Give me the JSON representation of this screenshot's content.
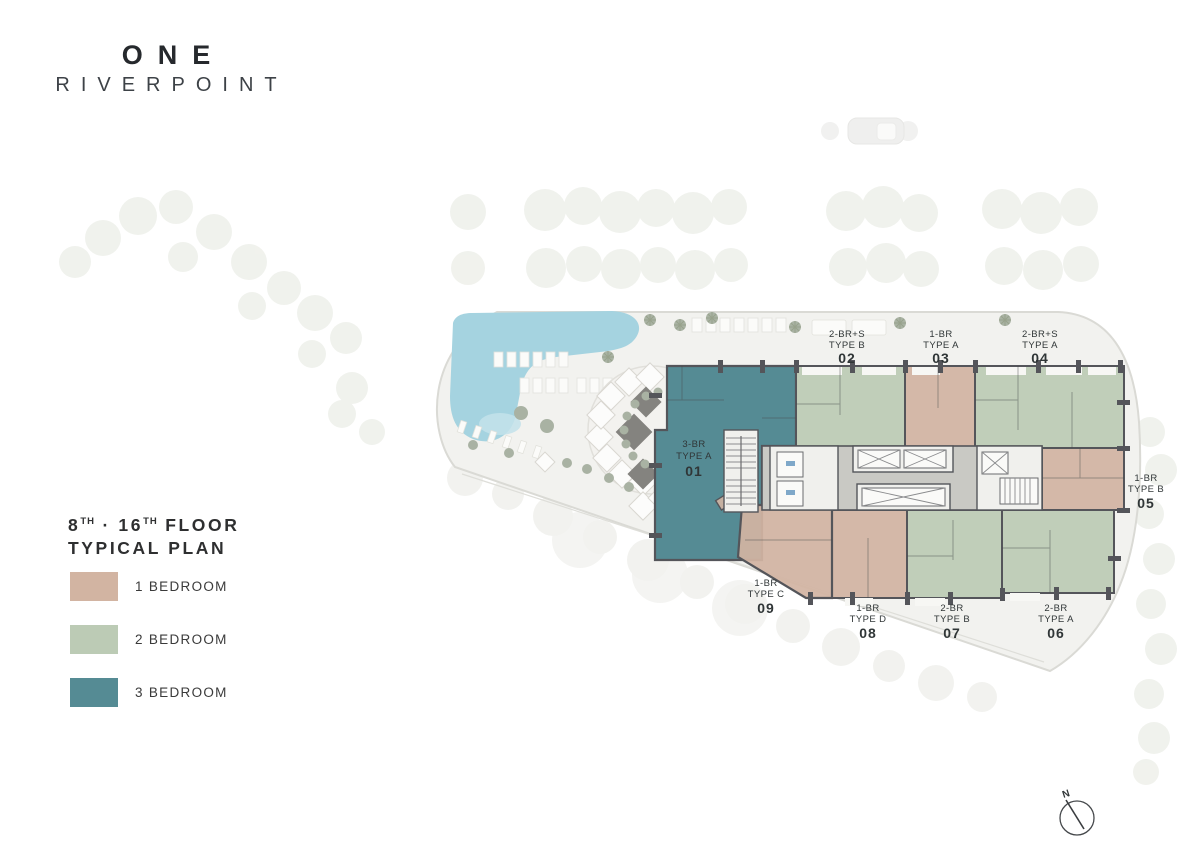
{
  "brand": {
    "name_line1": "ONE",
    "name_line2": "RIVERPOINT"
  },
  "plan_title": {
    "floor_start": "8",
    "sup1": "TH",
    "separator": "·",
    "floor_end": "16",
    "sup2": "TH",
    "floor_word": "FLOOR",
    "line2": "TYPICAL PLAN"
  },
  "legend": {
    "items": [
      {
        "label": "1 BEDROOM",
        "color": "#d2b4a2"
      },
      {
        "label": "2 BEDROOM",
        "color": "#bccbb5"
      },
      {
        "label": "3 BEDROOM",
        "color": "#558b94"
      }
    ]
  },
  "units": [
    {
      "number": "01",
      "line1": "3-BR",
      "line2": "TYPE A",
      "category": "3 Bedroom"
    },
    {
      "number": "02",
      "line1": "2-BR+S",
      "line2": "TYPE B",
      "category": "2 Bedroom"
    },
    {
      "number": "03",
      "line1": "1-BR",
      "line2": "TYPE A",
      "category": "1 Bedroom"
    },
    {
      "number": "04",
      "line1": "2-BR+S",
      "line2": "TYPE A",
      "category": "2 Bedroom"
    },
    {
      "number": "05",
      "line1": "1-BR",
      "line2": "TYPE B",
      "category": "1 Bedroom"
    },
    {
      "number": "06",
      "line1": "2-BR",
      "line2": "TYPE A",
      "category": "2 Bedroom"
    },
    {
      "number": "07",
      "line1": "2-BR",
      "line2": "TYPE B",
      "category": "2 Bedroom"
    },
    {
      "number": "08",
      "line1": "1-BR",
      "line2": "TYPE D",
      "category": "1 Bedroom"
    },
    {
      "number": "09",
      "line1": "1-BR",
      "line2": "TYPE C",
      "category": "1 Bedroom"
    }
  ],
  "compass": {
    "north_label": "N"
  },
  "colors": {
    "one_bedroom": "#d2b4a2",
    "two_bedroom": "#bccbb5",
    "three_bedroom": "#558b94",
    "pool": "#a5d3e0",
    "corridor": "#c9c9c4",
    "site_ground": "#f2f2ef",
    "site_outline": "#dadad5"
  }
}
